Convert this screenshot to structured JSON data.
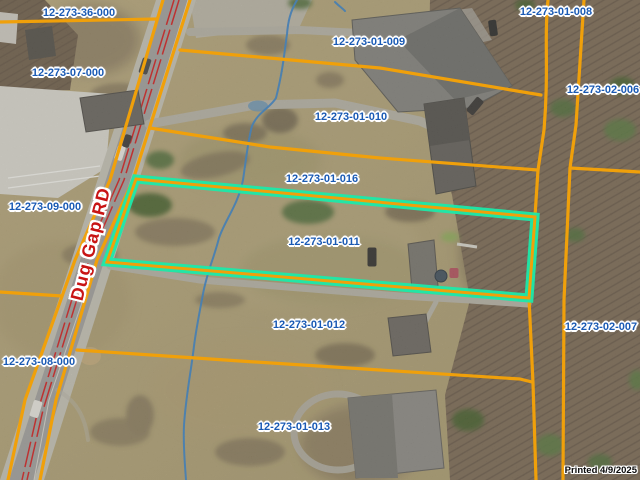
{
  "map": {
    "highlighted_parcel_id": "12-273-01-011",
    "road": {
      "label": "Dug Gap RD"
    },
    "stamp": {
      "text": "Printed 4/9/2025"
    },
    "parcel_labels": [
      {
        "id": "12-273-36-000",
        "x": 79,
        "y": 13
      },
      {
        "id": "12-273-07-000",
        "x": 68,
        "y": 73
      },
      {
        "id": "12-273-01-009",
        "x": 369,
        "y": 42
      },
      {
        "id": "12-273-01-008",
        "x": 556,
        "y": 12
      },
      {
        "id": "12-273-02-006",
        "x": 603,
        "y": 90
      },
      {
        "id": "12-273-01-010",
        "x": 351,
        "y": 117
      },
      {
        "id": "12-273-01-016",
        "x": 322,
        "y": 179
      },
      {
        "id": "12-273-09-000",
        "x": 45,
        "y": 207
      },
      {
        "id": "12-273-01-011",
        "x": 324,
        "y": 242
      },
      {
        "id": "12-273-01-012",
        "x": 309,
        "y": 325
      },
      {
        "id": "12-273-02-007",
        "x": 601,
        "y": 327
      },
      {
        "id": "12-273-08-000",
        "x": 39,
        "y": 362
      },
      {
        "id": "12-273-01-013",
        "x": 294,
        "y": 427
      }
    ],
    "colors": {
      "parcel_line": "#f0a00a",
      "highlight": "#1ce9a9",
      "label_text": "#1a5ab4",
      "road_label_text": "#c81414",
      "stream": "#3f85c4",
      "stamp_text": "#0b0b0b"
    }
  }
}
